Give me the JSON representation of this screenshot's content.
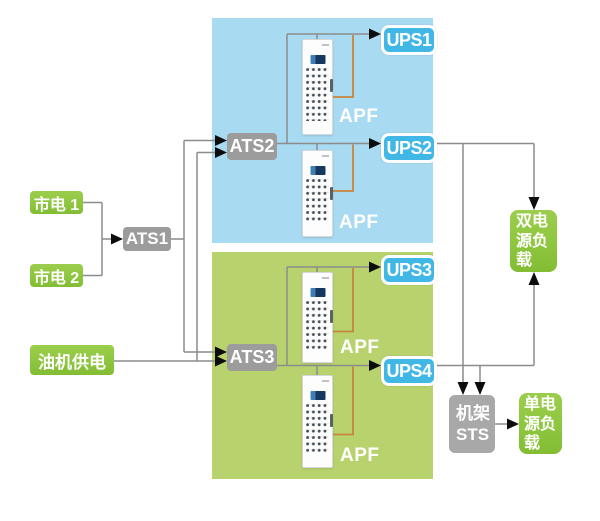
{
  "nodes": {
    "mains1": {
      "label": "市电 1"
    },
    "mains2": {
      "label": "市电 2"
    },
    "generator": {
      "label": "油机供电"
    },
    "ats1": {
      "label": "ATS1"
    },
    "ats2": {
      "label": "ATS2"
    },
    "ats3": {
      "label": "ATS3"
    },
    "ups1": {
      "label": "UPS1"
    },
    "ups2": {
      "label": "UPS2"
    },
    "ups3": {
      "label": "UPS3"
    },
    "ups4": {
      "label": "UPS4"
    },
    "apf": {
      "label": "APF"
    },
    "dual_load": {
      "label": "双电源负载"
    },
    "rack_sts": {
      "label": "机架STS"
    },
    "single_load": {
      "label": "单电源负载"
    }
  },
  "colors": {
    "region-blue": "#a8daf2",
    "region-green": "#b8d36e",
    "box-green": "#8ec63f",
    "box-gray": "#9c9c9c",
    "sts-gray": "#a8a8a8",
    "ups-blue": "#41b7e6",
    "line-gray": "#8c8c8c",
    "line-orange": "#c9853a",
    "arrow-black": "#0d0d0d"
  }
}
